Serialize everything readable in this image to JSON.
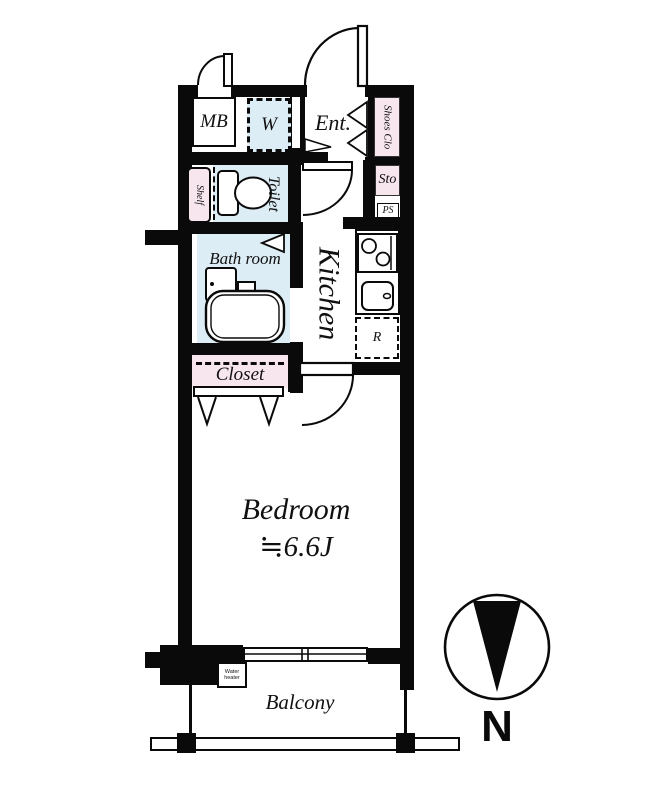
{
  "rooms": {
    "mb": "MB",
    "washer": "W",
    "entrance": "Ent.",
    "shoes_closet": "Shoes Clo",
    "shelf": "Shelf",
    "toilet": "Toilet",
    "storage": "Sto",
    "pipe_space": "PS",
    "bathroom": "Bath room",
    "kitchen": "Kitchen",
    "refrigerator": "R",
    "closet": "Closet",
    "bedroom": "Bedroom",
    "bedroom_size": "≒6.6J",
    "balcony": "Balcony",
    "water_heater": "Water heater"
  },
  "compass": {
    "north": "N"
  },
  "colors": {
    "wall": "#0a0a0a",
    "wet_area": "#ddedf5",
    "storage_area": "#f8e6ee"
  }
}
